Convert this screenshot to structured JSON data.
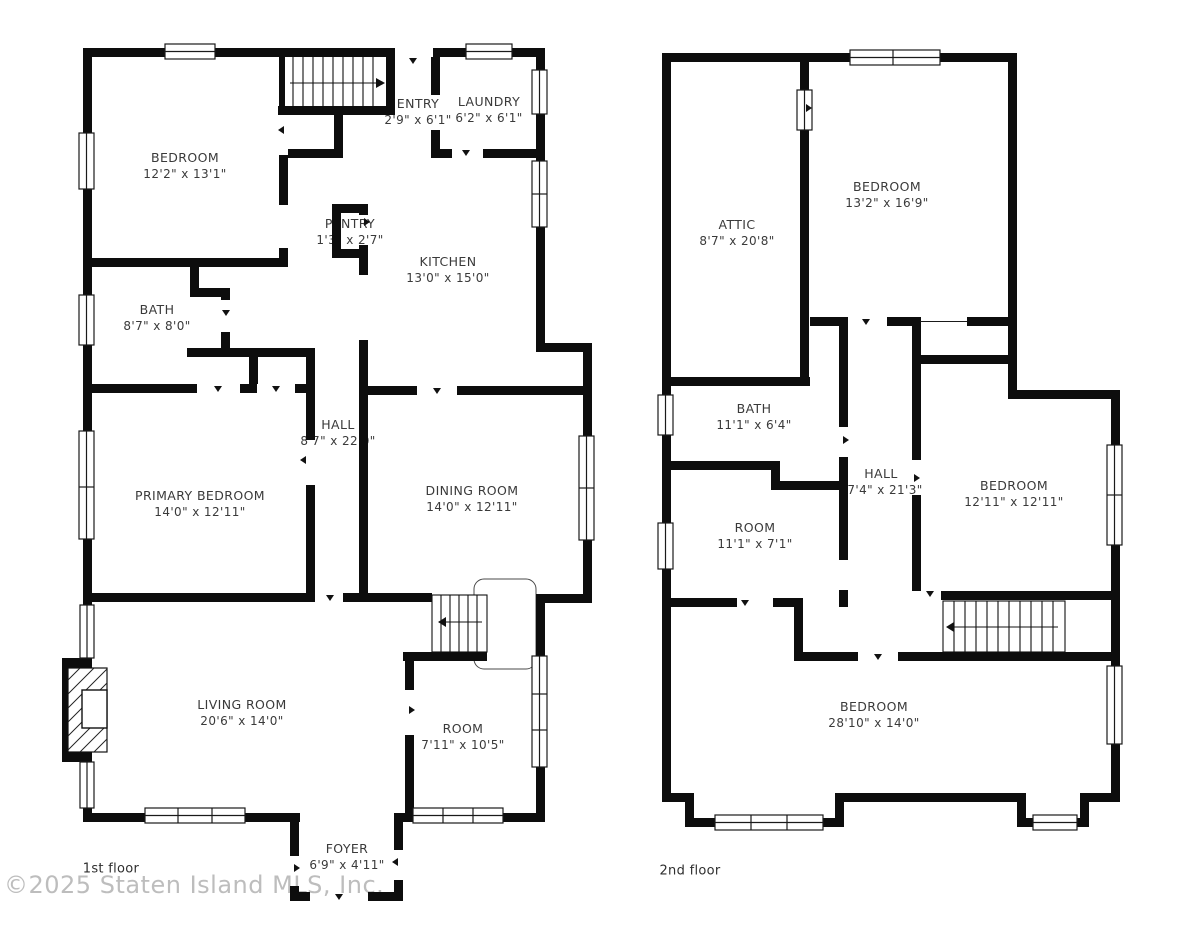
{
  "watermark": "©2025 Staten Island MLS, Inc.",
  "floor1": {
    "floor_label": "1st floor",
    "rooms": [
      {
        "name": "BEDROOM",
        "dims": "12'2\" x 13'1\""
      },
      {
        "name": "ENTRY",
        "dims": "2'9\" x 6'1\""
      },
      {
        "name": "LAUNDRY",
        "dims": "6'2\" x 6'1\""
      },
      {
        "name": "PANTRY",
        "dims": "1'3\" x 2'7\""
      },
      {
        "name": "KITCHEN",
        "dims": "13'0\" x 15'0\""
      },
      {
        "name": "BATH",
        "dims": "8'7\" x 8'0\""
      },
      {
        "name": "HALL",
        "dims": "8'7\" x 22'0\""
      },
      {
        "name": "PRIMARY BEDROOM",
        "dims": "14'0\" x 12'11\""
      },
      {
        "name": "DINING ROOM",
        "dims": "14'0\" x 12'11\""
      },
      {
        "name": "LIVING ROOM",
        "dims": "20'6\" x 14'0\""
      },
      {
        "name": "ROOM",
        "dims": "7'11\" x 10'5\""
      },
      {
        "name": "FOYER",
        "dims": "6'9\" x 4'11\""
      }
    ]
  },
  "floor2": {
    "floor_label": "2nd floor",
    "rooms": [
      {
        "name": "ATTIC",
        "dims": "8'7\" x 20'8\""
      },
      {
        "name": "BEDROOM",
        "dims": "13'2\" x 16'9\""
      },
      {
        "name": "BATH",
        "dims": "11'1\" x 6'4\""
      },
      {
        "name": "HALL",
        "dims": "17'4\" x 21'3\""
      },
      {
        "name": "BEDROOM",
        "dims": "12'11\" x 12'11\""
      },
      {
        "name": "ROOM",
        "dims": "11'1\" x 7'1\""
      },
      {
        "name": "BEDROOM",
        "dims": "28'10\" x 14'0\""
      }
    ]
  }
}
